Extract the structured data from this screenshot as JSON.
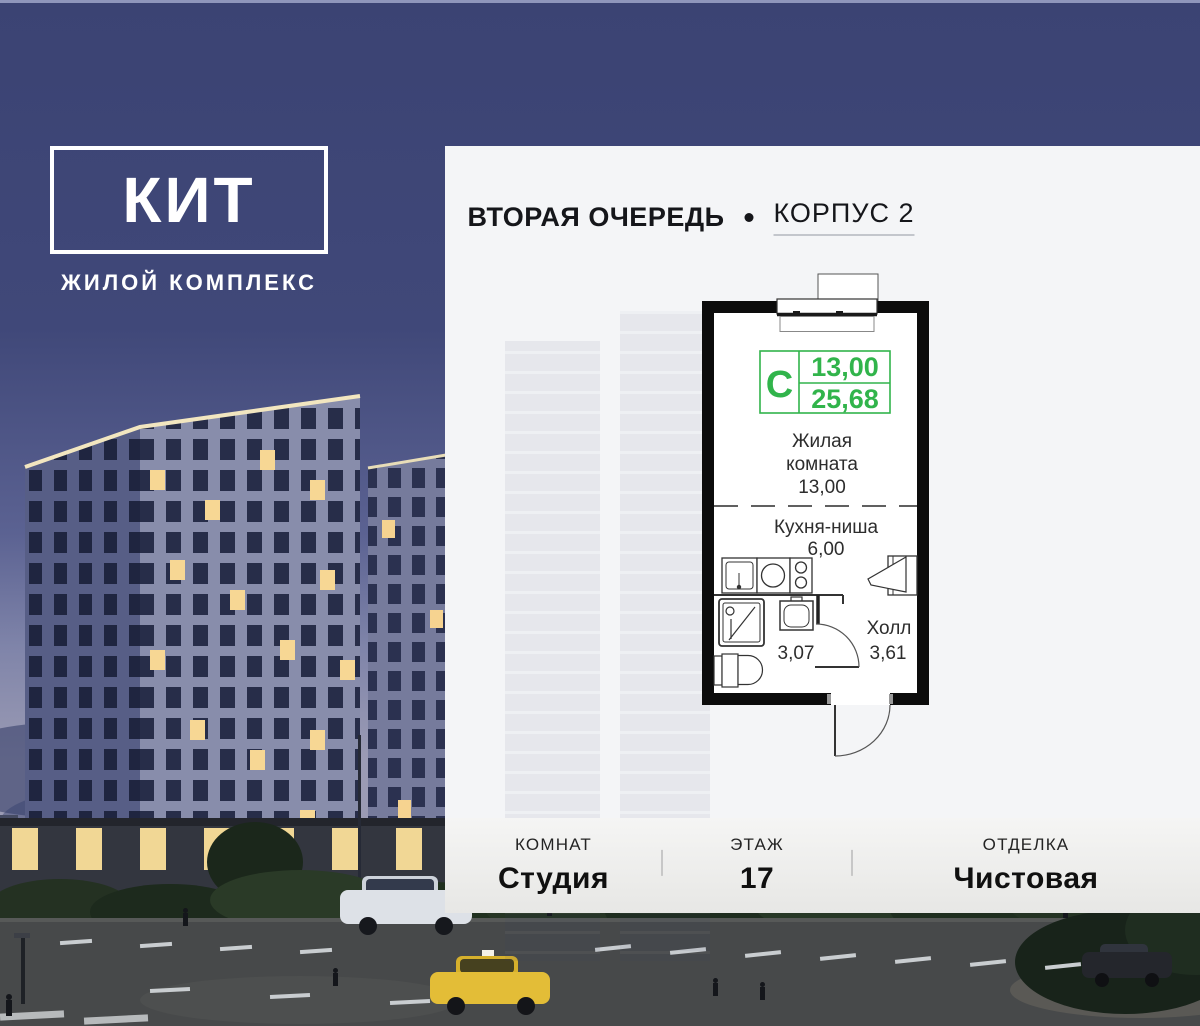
{
  "logo": {
    "title": "КИТ",
    "subtitle": "ЖИЛОЙ КОМПЛЕКС"
  },
  "header": {
    "phase": "ВТОРАЯ ОЧЕРЕДЬ",
    "building_link": "КОРПУС 2"
  },
  "plan": {
    "badge": "С",
    "area_living": "13,00",
    "area_total": "25,68",
    "living_label_line1": "Жилая",
    "living_label_line2": "комната",
    "living_area": "13,00",
    "kitchen_label": "Кухня-ниша",
    "kitchen_area": "6,00",
    "bath_area": "3,07",
    "hall_label": "Холл",
    "hall_area": "3,61"
  },
  "footer": {
    "columns": [
      {
        "label": "КОМНАТ",
        "value": "Студия"
      },
      {
        "label": "ЭТАЖ",
        "value": "17"
      },
      {
        "label": "ОТДЕЛКА",
        "value": "Чистовая"
      }
    ]
  },
  "colors": {
    "accent_green": "#31B44B",
    "sky": "#3D4577",
    "panel": "#F4F5F7",
    "wall": "#0C0C0C",
    "text": "#2D2D2D"
  }
}
